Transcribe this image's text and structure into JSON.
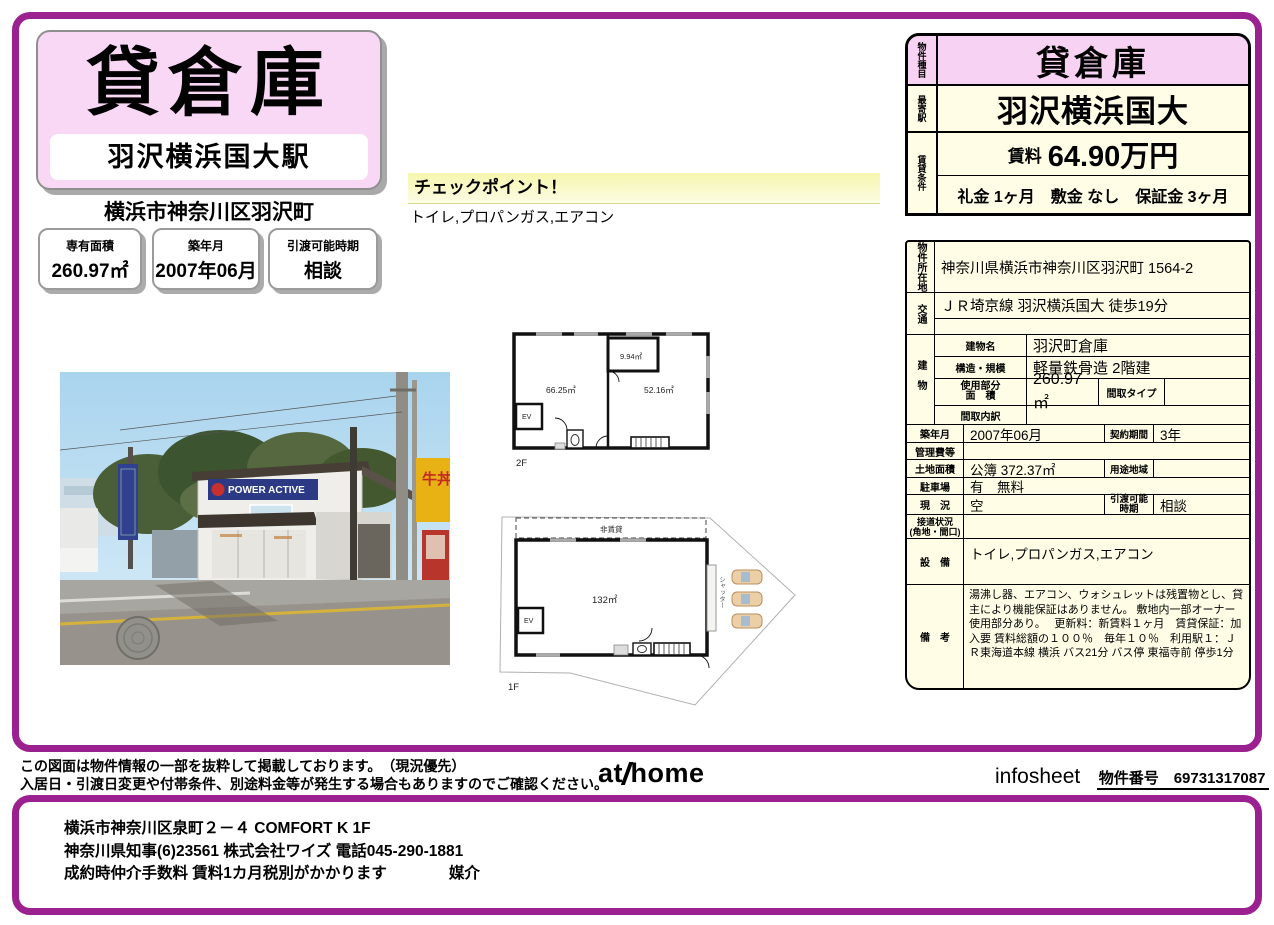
{
  "colors": {
    "accent_purple": "#9b2190",
    "pink": "#f8d2f2",
    "cream": "#fffde6"
  },
  "title_card": {
    "property_type": "貸倉庫",
    "station": "羽沢横浜国大駅",
    "address": "横浜市神奈川区羽沢町"
  },
  "badges": [
    {
      "label": "専有面積",
      "value": "260.97㎡"
    },
    {
      "label": "築年月",
      "value": "2007年06月"
    },
    {
      "label": "引渡可能時期",
      "value": "相談"
    }
  ],
  "checkpoint": {
    "title": "チェックポイント！",
    "items": "トイレ,プロパンガス,エアコン"
  },
  "photo": {
    "building_sign": "POWER ACTIVE",
    "shop_sign": "牛丼"
  },
  "floorplan_2f": {
    "room_left": "66.25㎡",
    "room_right": "52.16㎡",
    "room_small": "9.94㎡",
    "elevator": "EV",
    "floor_label": "2F"
  },
  "floorplan_1f": {
    "area": "132㎡",
    "elevator": "EV",
    "non_rental": "非賃貸",
    "shutter": "シャッター",
    "floor_label": "1F"
  },
  "summary": {
    "type_label": "物件種目",
    "type": "貸倉庫",
    "station_label": "最寄駅",
    "station": "羽沢横浜国大",
    "terms_label": "賃貸条件",
    "rent_label": "賃料",
    "rent": "64.90万円",
    "terms": "礼金 1ヶ月　敷金 なし　保証金 3ヶ月"
  },
  "details": {
    "location_label": "物件所在地",
    "location": "神奈川県横浜市神奈川区羽沢町 1564-2",
    "access_label": "交通",
    "access": "ＪＲ埼京線 羽沢横浜国大 徒歩19分",
    "access_line2": "",
    "building_label": "建物",
    "building_name_label": "建物名",
    "building_name": "羽沢町倉庫",
    "structure_label": "構造・規模",
    "structure": "軽量鉄骨造 2階建",
    "used_area_label1": "使用部分",
    "used_area_label2": "面　積",
    "used_area": "260.97㎡",
    "layout_type_label": "間取タイプ",
    "layout_type": "",
    "layout_detail_label": "間取内訳",
    "layout_detail": "",
    "built_label": "築年月",
    "built": "2007年06月",
    "contract_label": "契約期間",
    "contract": "3年",
    "fees_label": "管理費等",
    "fees": "",
    "land_label": "土地面積",
    "land": "公簿 372.37㎡",
    "zone_label": "用途地域",
    "zone": "",
    "parking_label": "駐車場",
    "parking": "有　無料",
    "status_label": "現　況",
    "status": "空",
    "handover_label": "引渡可能 時期",
    "handover": "相談",
    "road_label1": "接道状況",
    "road_label2": "(角地・間口)",
    "road": "",
    "equipment_label": "設　備",
    "equipment": "トイレ,プロパンガス,エアコン",
    "remarks_label": "備　考",
    "remarks": "湯沸し器、エアコン、ウォシュレットは残置物とし、貸主により機能保証はありません。 敷地内一部オーナー使用部分あり。　 更新料：新賃料１ヶ月　賃貸保証：加入要 賃料総額の１００％　毎年１０％　利用駅１：ＪＲ東海道本線 横浜 バス21分 バス停 東福寺前 停歩1分"
  },
  "footer": {
    "disclaimer1": "この図面は物件情報の一部を抜粋して掲載しております。　（現況優先）",
    "disclaimer2": "入居日・引渡日変更や付帯条件、別途料金等が発生する場合もありますのでご確認ください。",
    "logo_at": "at",
    "logo_home": "home",
    "infosheet": "infosheet",
    "property_number": "物件番号　69731317087"
  },
  "agent": {
    "line1": "横浜市神奈川区泉町２－４  COMFORT  K  1F",
    "line2": "神奈川県知事(6)23561  株式会社ワイズ  電話045-290-1881",
    "line3": "成約時仲介手数料  賃料1カ月税別がかかります　　　　媒介"
  }
}
